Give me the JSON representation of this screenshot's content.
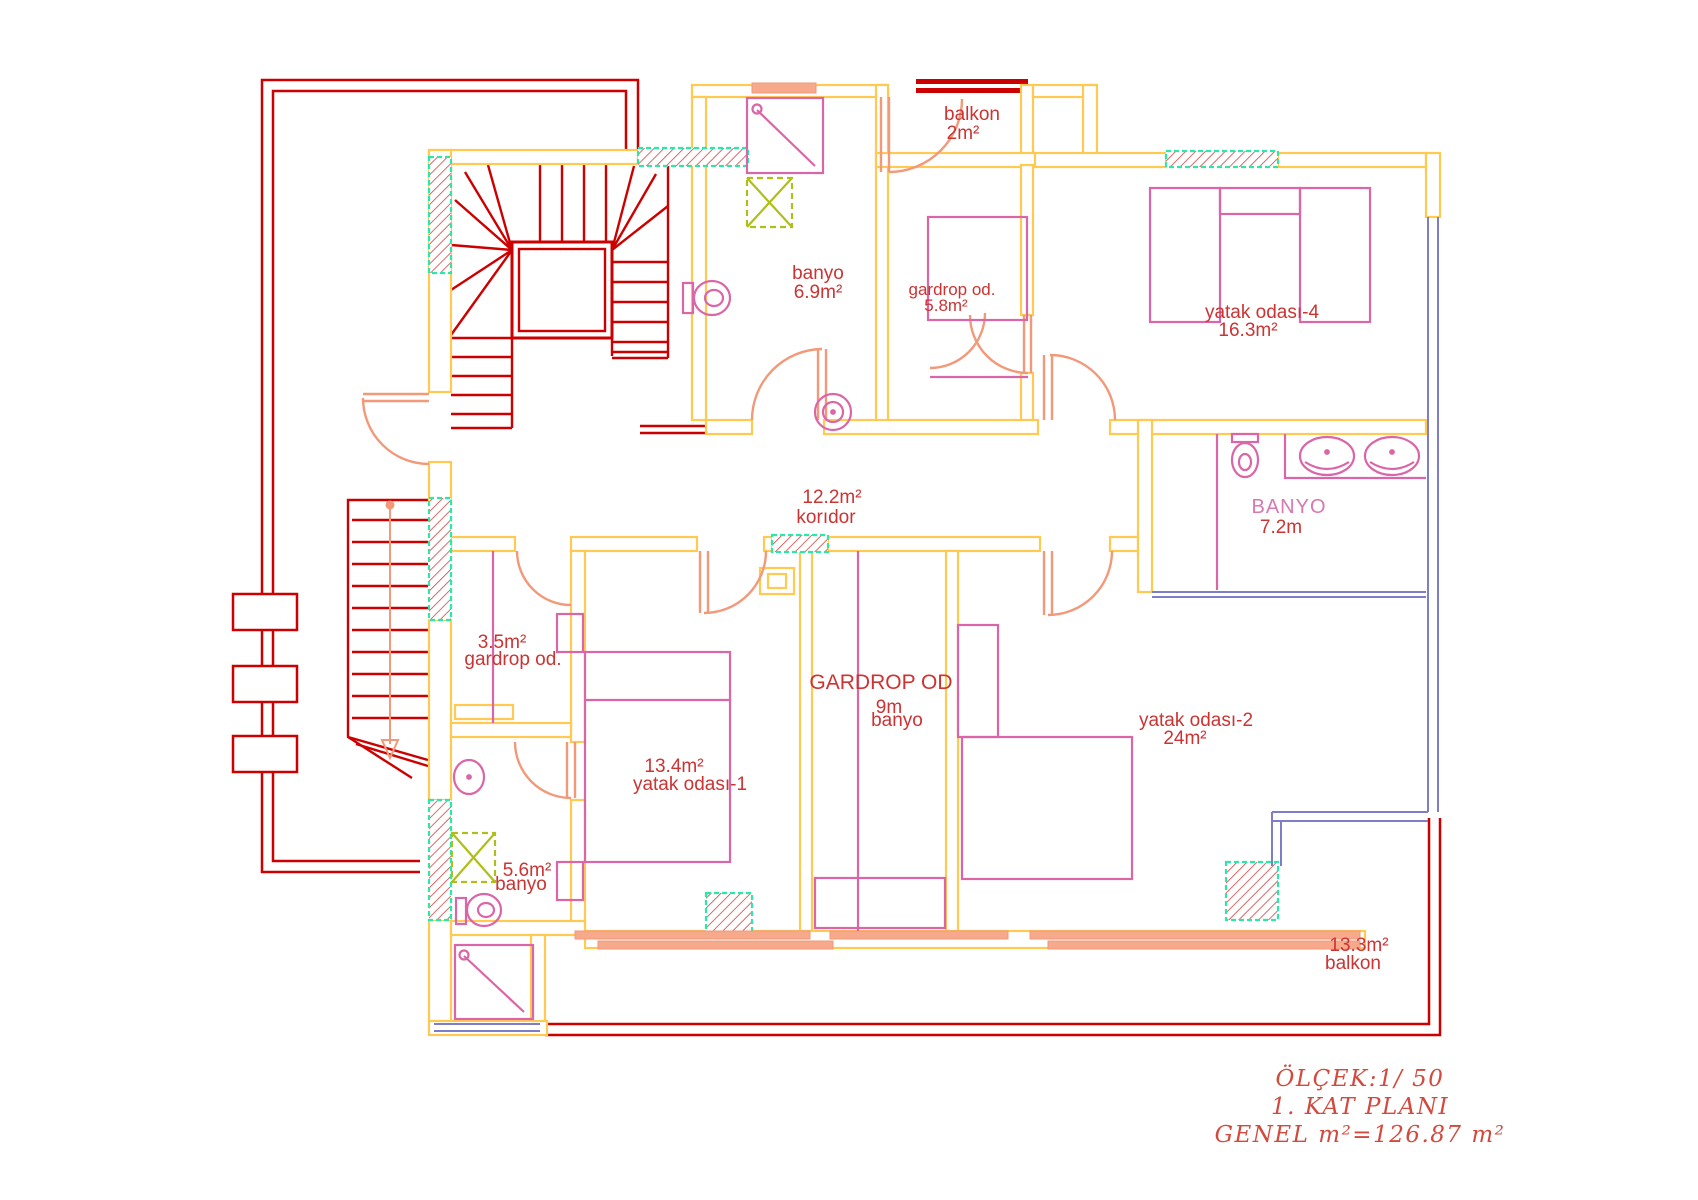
{
  "plan": {
    "rooms": [
      {
        "name": "balkon",
        "area": "2m²"
      },
      {
        "name": "banyo",
        "area": "6.9m²"
      },
      {
        "name": "gardrop od.",
        "area": "5.8m²"
      },
      {
        "name": "yatak odası-4",
        "area": "16.3m²"
      },
      {
        "name": "korıdor",
        "area": "12.2m²"
      },
      {
        "name": "BANYO",
        "area": "7.2m"
      },
      {
        "name": "gardrop od.",
        "area": "3.5m²"
      },
      {
        "name": "yatak odası-1",
        "area": "13.4m²"
      },
      {
        "name": "GARDROP OD",
        "area": "9m",
        "sub": "banyo"
      },
      {
        "name": "yatak odası-2",
        "area": "24m²"
      },
      {
        "name": "banyo",
        "area": "5.6m²"
      },
      {
        "name": "balkon",
        "area": "13.3m²"
      }
    ],
    "title_block": {
      "scale": "ÖLÇEK:1/ 50",
      "floor": "1. KAT PLANI",
      "total_area": "GENEL m²=126.87 m²"
    },
    "colors": {
      "walls": "#FFC952",
      "stairs_rail": "#CC0000",
      "doors": "#F2997A",
      "furniture": "#DA66A8",
      "windows": "#7D7DC8",
      "column_border": "#2BE8A6",
      "shaft": "#AFBE18",
      "label_red": "#CC3333",
      "label_pink": "#D778B0"
    }
  }
}
